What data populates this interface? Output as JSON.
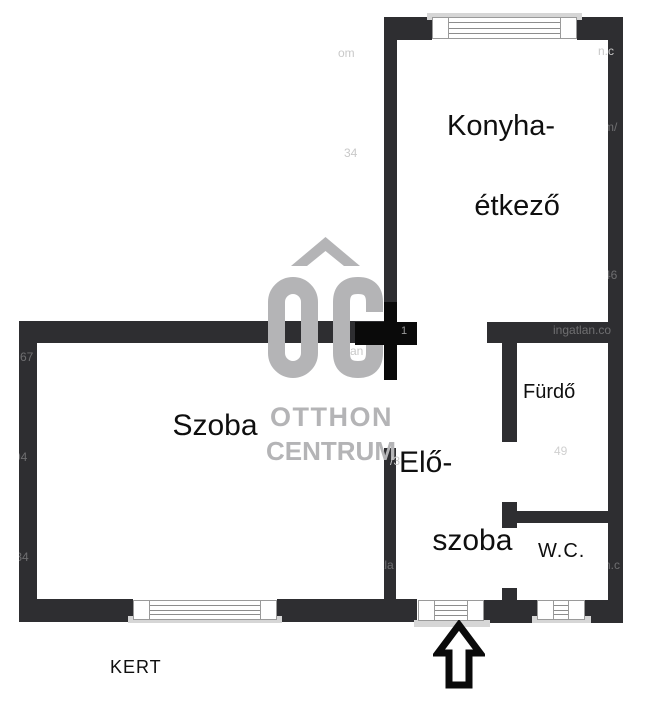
{
  "floorplan": {
    "rooms": {
      "kitchen_dining": {
        "line1": "Konyha-",
        "line2": "étkező"
      },
      "room": {
        "label": "Szoba"
      },
      "hallway": {
        "line1": "Elő-",
        "line2": "szoba"
      },
      "bathroom": {
        "label": "Fürdő"
      },
      "wc": {
        "label": "W.C."
      }
    },
    "outside": {
      "garden_label": "KERT"
    }
  },
  "watermark": {
    "logo_letters": "OC",
    "brand_line1": "OTTHON",
    "brand_line2": "CENTRUM",
    "fragments": [
      "om",
      "n.c",
      "m/",
      "34",
      "46",
      "ingatlan.co",
      "67",
      "an",
      "1",
      "/3",
      "94",
      "49",
      "/34",
      "tla",
      "n.c"
    ]
  },
  "colors": {
    "wall": "#2e2e31",
    "pillar_black": "#0a0a0a",
    "window_frame": "#9a9a9a",
    "window_sill": "#d6d6d6",
    "watermark": "#b4b4b6",
    "label_text": "#0f0f0f"
  }
}
